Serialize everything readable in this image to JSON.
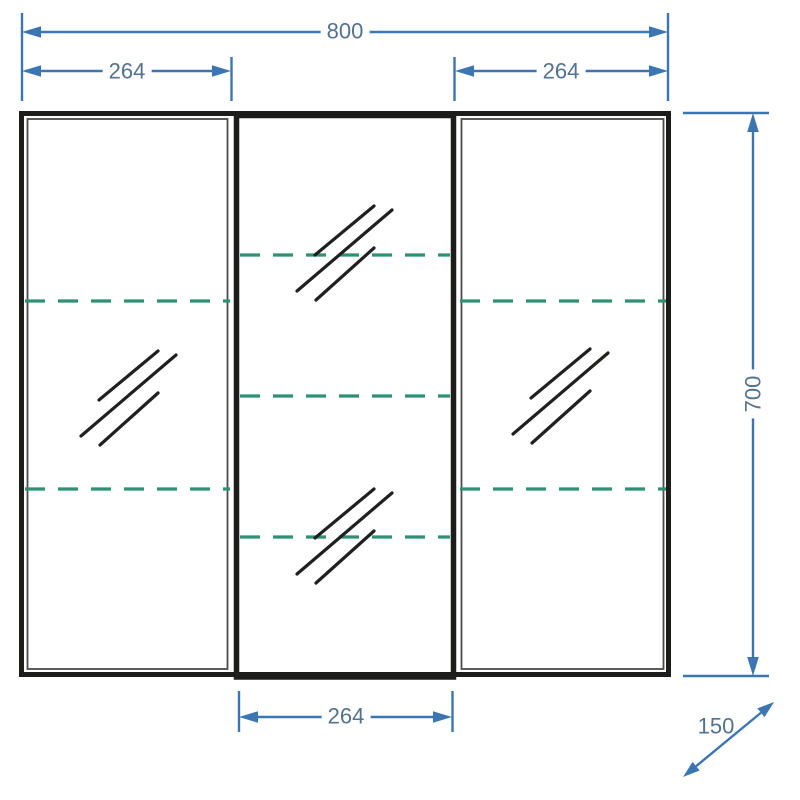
{
  "watermark": {
    "text": "www.aquamir.ru"
  },
  "dimensions": {
    "overall_width": "800",
    "left_door_width": "264",
    "right_door_width": "264",
    "middle_door_width": "264",
    "overall_height": "700",
    "depth": "150"
  },
  "symbols": {
    "mirror_hatch_icon": "three parallel diagonal strokes (mirror/glass surface)",
    "shelf_line": "green dashed horizontal line (shelf position)"
  },
  "colors": {
    "dimension_line": "#3b76b2",
    "dimension_text": "#54718f",
    "shelf_dash": "#2e9173",
    "frame": "#1d1d1b",
    "watermark_text": "#e6e6e6",
    "background": "#ffffff"
  }
}
